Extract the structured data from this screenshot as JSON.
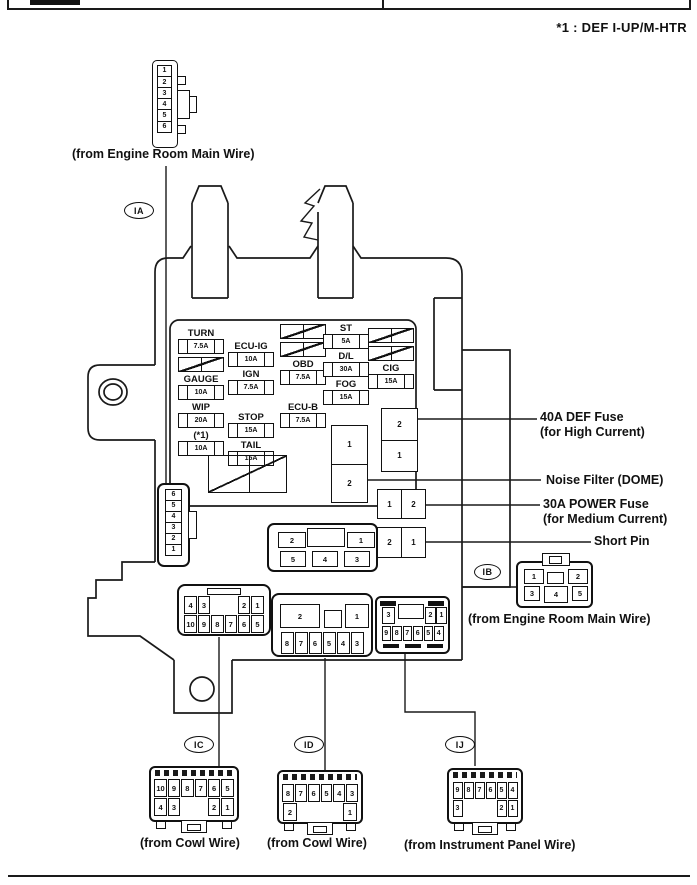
{
  "page": {
    "top_note": "*1 : DEF I-UP/M-HTR"
  },
  "ovals": {
    "ia": "IA",
    "ib": "IB",
    "ic": "IC",
    "id": "ID",
    "ij": "IJ"
  },
  "wire_labels": {
    "top_connector": "(from Engine Room Main Wire)",
    "ib_connector": "(from Engine Room Main Wire)",
    "ic_connector": "(from Cowl Wire)",
    "id_connector": "(from Cowl Wire)",
    "ij_connector": "(from Instrument Panel Wire)"
  },
  "callouts": {
    "def_fuse": {
      "line1": "40A DEF Fuse",
      "line2": "(for High Current)"
    },
    "noise_filter": {
      "line1": "Noise Filter (DOME)"
    },
    "power_fuse": {
      "line1": "30A POWER Fuse",
      "line2": "(for Medium Current)"
    },
    "short_pin": {
      "line1": "Short Pin"
    }
  },
  "fuse_columns": {
    "col1": [
      {
        "label": "TURN",
        "amp": "7.5A"
      },
      {
        "type": "blank"
      },
      {
        "label": "GAUGE",
        "amp": "10A"
      },
      {
        "label": "WIP",
        "amp": "20A"
      },
      {
        "label": "(*1)",
        "amp": "10A"
      }
    ],
    "col2": [
      {
        "label": "ECU-IG",
        "amp": "10A"
      },
      {
        "label": "IGN",
        "amp": "7.5A"
      },
      {
        "type": "spacer"
      },
      {
        "label": "STOP",
        "amp": "15A"
      },
      {
        "label": "TAIL",
        "amp": "15A"
      }
    ],
    "col3": [
      {
        "type": "blank"
      },
      {
        "type": "blank"
      },
      {
        "label": "OBD",
        "amp": "7.5A"
      },
      {
        "type": "spacer"
      },
      {
        "label": "ECU-B",
        "amp": "7.5A"
      }
    ],
    "col4": [
      {
        "label": "ST",
        "amp": "5A"
      },
      {
        "label": "D/L",
        "amp": "30A"
      },
      {
        "label": "FOG",
        "amp": "15A"
      }
    ],
    "col5": [
      {
        "type": "blank"
      },
      {
        "type": "blank"
      },
      {
        "label": "CIG",
        "amp": "15A"
      }
    ]
  },
  "relays": {
    "def_fuse_cells": [
      "2",
      "1"
    ],
    "noise_filter_cells": [
      "1",
      "2"
    ],
    "power_fuse_cells": [
      "1",
      "2"
    ],
    "short_pin_cells": [
      "2",
      "1"
    ]
  },
  "connectors": {
    "top_left_pins": [
      "1",
      "2",
      "3",
      "4",
      "5",
      "6"
    ],
    "side_pins": [
      "6",
      "5",
      "4",
      "3",
      "2",
      "1"
    ],
    "center_block": {
      "pins": [
        "2",
        "1",
        "5",
        "4",
        "3"
      ]
    },
    "ic_block": {
      "row1": [
        "4",
        "3",
        "",
        "",
        "2",
        "1"
      ],
      "row2": [
        "10",
        "9",
        "8",
        "7",
        "6",
        "5"
      ]
    },
    "id_block": {
      "row1": [
        "2",
        "1"
      ],
      "row2": [
        "8",
        "7",
        "6",
        "5",
        "4",
        "3"
      ]
    },
    "ij_block": {
      "row1": [
        "3",
        "2",
        "1"
      ],
      "row2": [
        "9",
        "8",
        "7",
        "6",
        "5",
        "4"
      ]
    },
    "ib": {
      "pins": [
        "1",
        "2",
        "3",
        "4",
        "5"
      ]
    },
    "bottom_ic": {
      "row1": [
        "10",
        "9",
        "8",
        "7",
        "6",
        "5"
      ],
      "row2": [
        "4",
        "3",
        "",
        "",
        "2",
        "1"
      ]
    },
    "bottom_id": {
      "row1": [
        "8",
        "7",
        "6",
        "5",
        "4",
        "3"
      ],
      "row2": [
        "2",
        "",
        "",
        "",
        "1"
      ]
    },
    "bottom_ij": {
      "row1": [
        "9",
        "8",
        "7",
        "6",
        "5",
        "4"
      ],
      "row2": [
        "3",
        "",
        "",
        "",
        "2",
        "1"
      ]
    }
  }
}
